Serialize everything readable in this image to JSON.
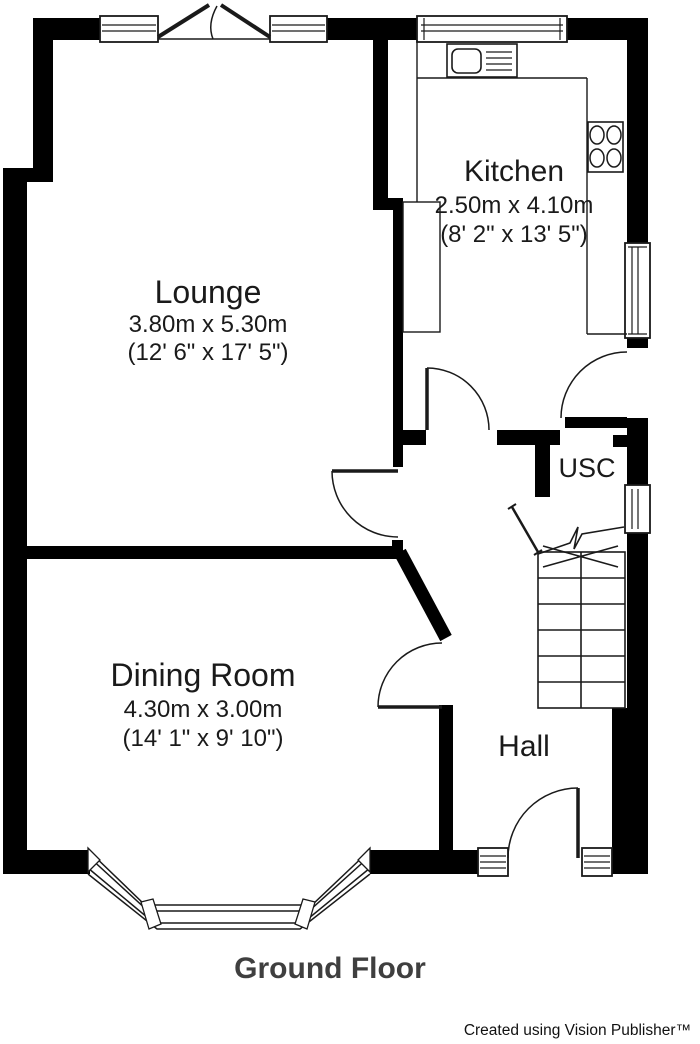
{
  "title": {
    "floor_label": "Ground Floor"
  },
  "credit": {
    "text": "Created using Vision Publisher™"
  },
  "rooms": {
    "kitchen": {
      "label": "Kitchen",
      "metric": "2.50m x 4.10m",
      "imperial": "(8' 2\" x 13' 5\")"
    },
    "lounge": {
      "label": "Lounge",
      "metric": "3.80m x 5.30m",
      "imperial": "(12' 6\" x 17' 5\")"
    },
    "dining_room": {
      "label": "Dining Room",
      "metric": "4.30m x 3.00m",
      "imperial": "(14' 1\" x 9' 10\")"
    },
    "usc": {
      "label": "USC"
    },
    "hall": {
      "label": "Hall"
    }
  },
  "colors": {
    "wall": "#000000",
    "line": "#1a1a1a",
    "text": "#1a1a1a",
    "floor_title": "#3f3f3f",
    "background": "#ffffff"
  }
}
